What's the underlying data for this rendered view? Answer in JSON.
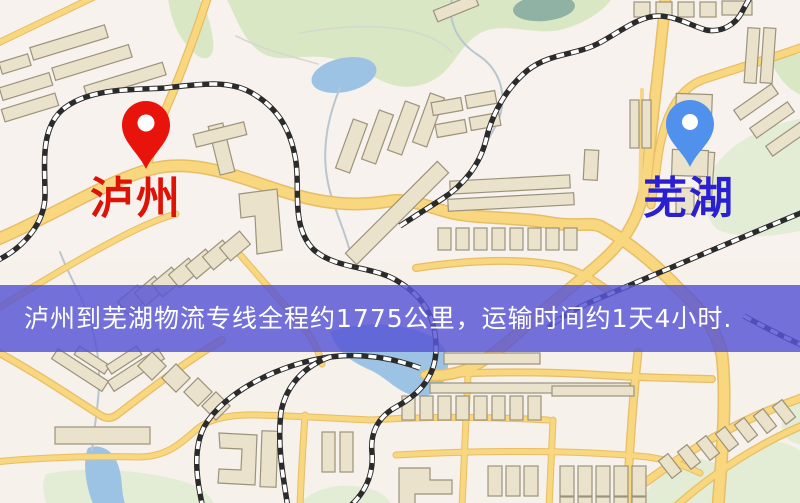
{
  "page": {
    "type": "logistics-route-map",
    "width": 800,
    "height": 503
  },
  "map": {
    "background_color": "#f6f1ea",
    "road_color": "#f8d77f",
    "park_color": "#d9e7c4",
    "water_color": "#9cc3e4",
    "building_color": "#eae2ca",
    "railway_color": "#2b2b2b",
    "markers": [
      {
        "id": "origin",
        "name": "泸州",
        "pin_color": "#e8130a",
        "label_color": "#df1206"
      },
      {
        "id": "destination",
        "name": "芜湖",
        "pin_color": "#5091ee",
        "label_color": "#2a20d0"
      }
    ]
  },
  "banner": {
    "text": "泸州到芜湖物流专线全程约1775公里，运输时间约1天4小时.",
    "background_color": "#5856d5",
    "text_color": "#ffffff",
    "distance": "约1775公里",
    "duration": "约1天4小时"
  }
}
